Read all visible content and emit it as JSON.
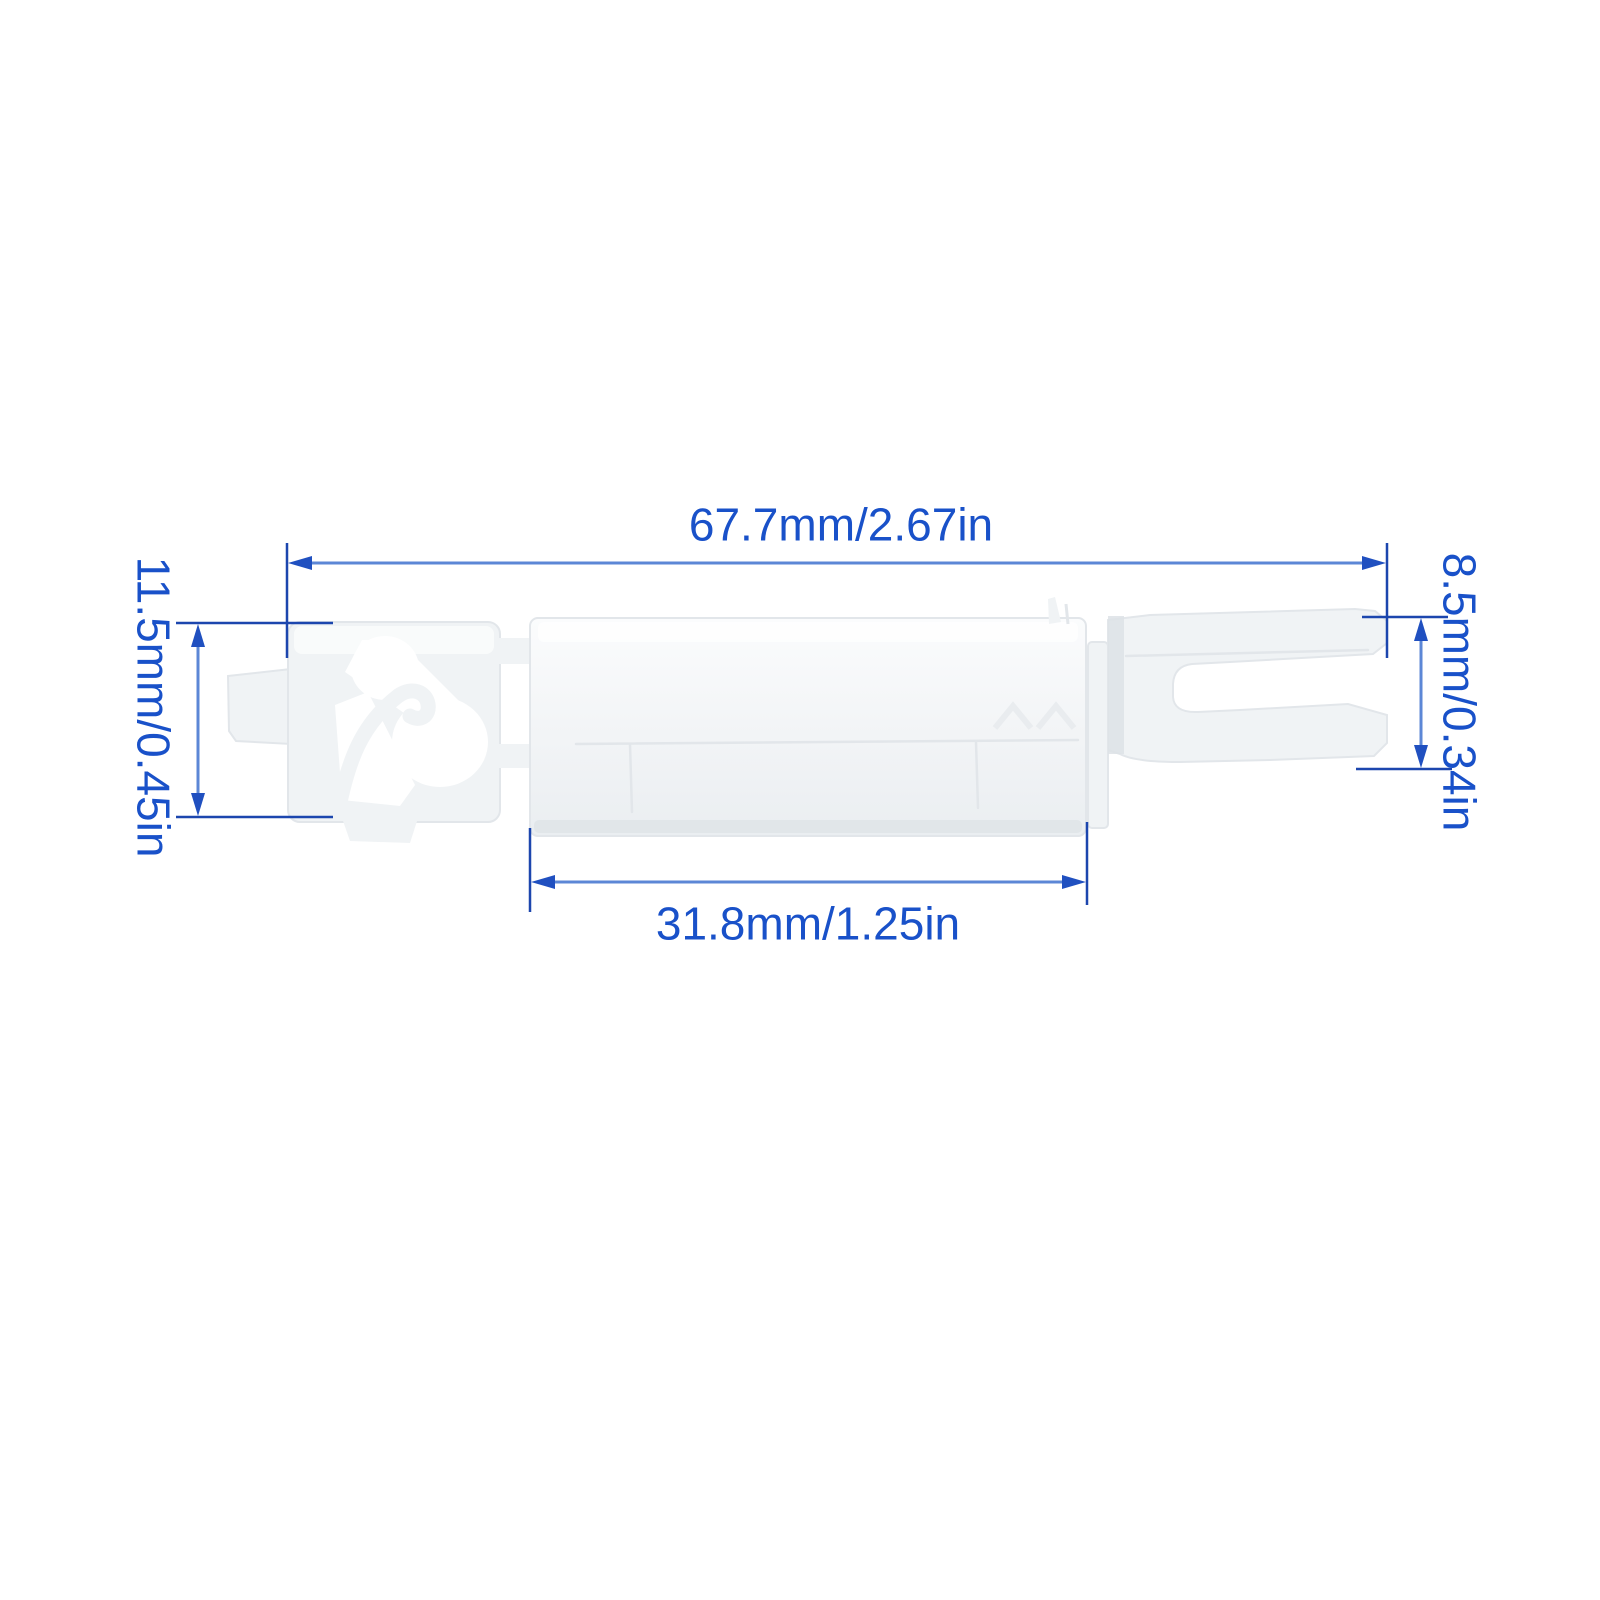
{
  "diagram": {
    "type": "product-dimension-drawing",
    "part": "white plastic clip with side hook and fork end",
    "dimensions": {
      "overall_length": {
        "label": "67.7mm/2.67in",
        "orientation": "horizontal"
      },
      "clip_height": {
        "label": "11.5mm/0.45in",
        "orientation": "vertical-rotated"
      },
      "body_length": {
        "label": "31.8mm/1.25in",
        "orientation": "horizontal"
      },
      "fork_height": {
        "label": "8.5mm/0.34in",
        "orientation": "vertical-rotated"
      }
    },
    "colors": {
      "background": "#ffffff",
      "dimension_text": "#1951c9",
      "dimension_line": "#5c87d6",
      "extension_line": "#1c46ae",
      "arrowhead": "#2050c0",
      "part_fill": "#f0f3f5",
      "part_edge": "#e2e6ea",
      "part_shadow": "#dde2e6",
      "part_highlight": "#fbfcfd",
      "cutout": "#ffffff"
    }
  }
}
